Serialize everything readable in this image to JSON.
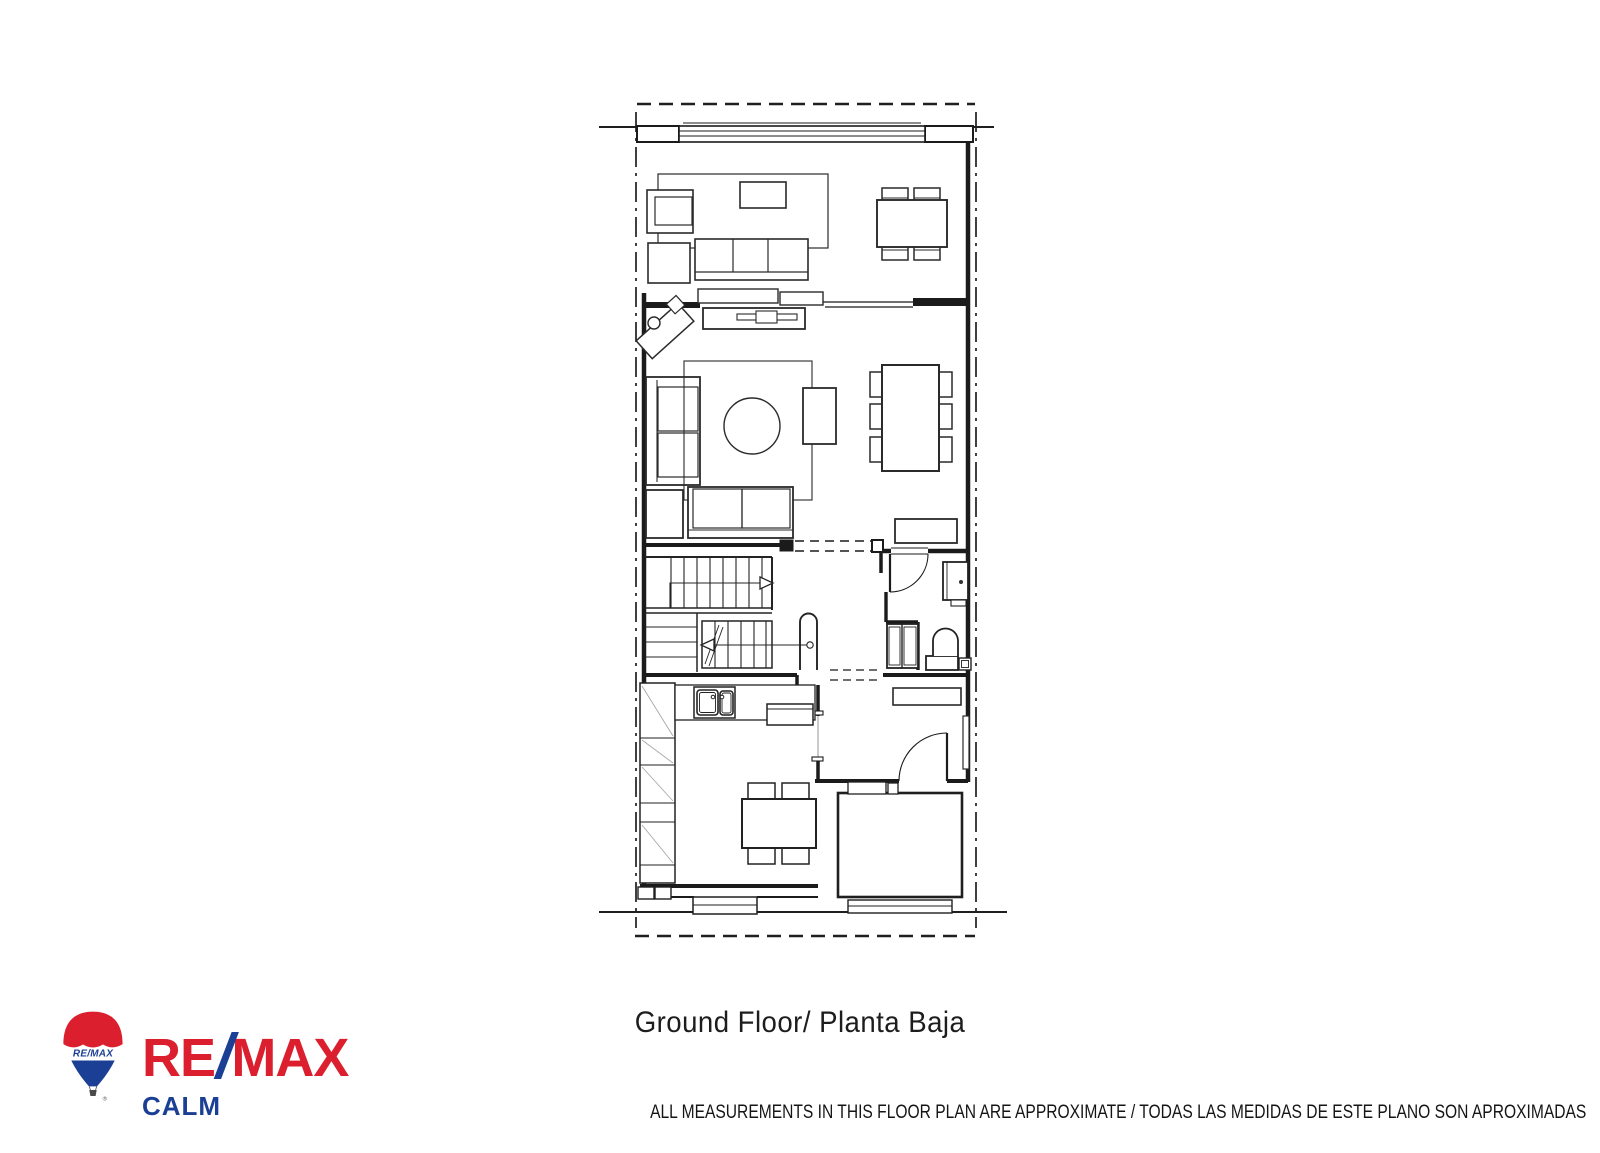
{
  "plan": {
    "caption": "Ground Floor/ Planta Baja"
  },
  "footer": {
    "disclaimer": "ALL MEASUREMENTS IN THIS FLOOR PLAN ARE APPROXIMATE / TODAS LAS MEDIDAS DE ESTE PLANO SON APROXIMADAS"
  },
  "logo": {
    "brand_re": "RE",
    "brand_slash": "/",
    "brand_max": "MAX",
    "office": "CALM",
    "balloon_text": "RE/MAX",
    "registered_mark": "®",
    "colors": {
      "red": "#DB1F2E",
      "blue": "#1B3F94"
    }
  },
  "drawing": {
    "ink_color": "#1f1f1f",
    "faint_color": "#a8a8a8"
  }
}
